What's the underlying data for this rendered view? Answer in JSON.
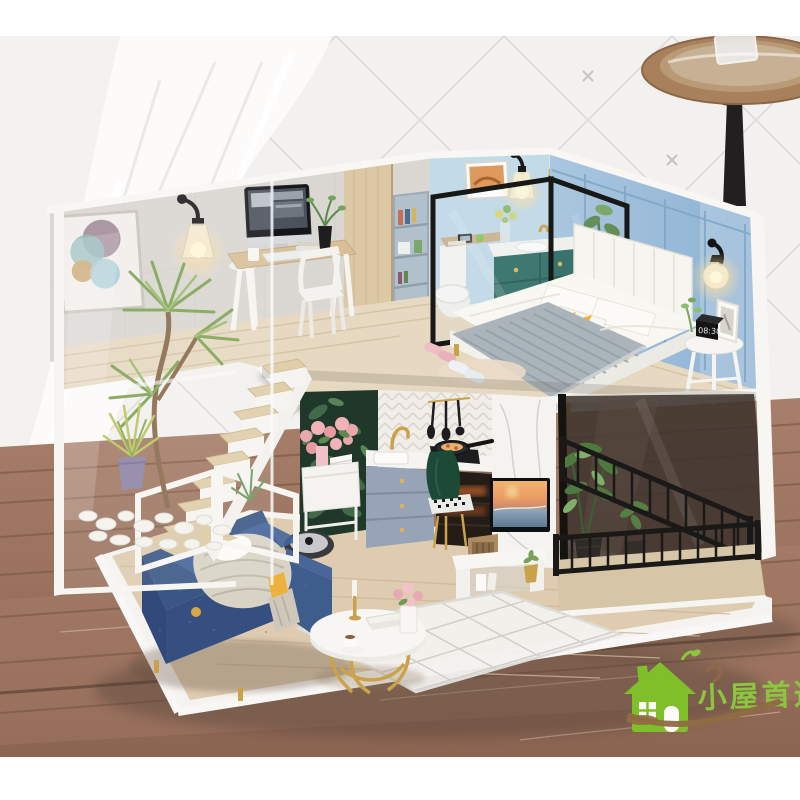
{
  "meta": {
    "domain": "Natural-Image",
    "subject": "Product photo of a DIY miniature dollhouse loft apartment displayed on a rustic wooden table"
  },
  "watermark": {
    "text": "小屋首选",
    "text_color": "#8cc63e",
    "swoosh_color": "#8f6b42",
    "icon": "green-house-icon"
  },
  "scene": {
    "clock_display": "08:30",
    "palette": {
      "background_wall": "#f3f1ef",
      "lace_curtain": "#fcfbfa",
      "table_wood": "#9b7360",
      "house_trim_white": "#f7f6f3",
      "bedroom_wall_blue": "#9cbddb",
      "bathroom_wall_blue": "#c3dae8",
      "vanity_teal": "#2f6b66",
      "sofa_blue": "#3c5c8c",
      "loft_floor_wood": "#e7d9c1",
      "kitchen_cabinet_gray": "#97a3b6",
      "kitchen_leaf_wallpaper": "#20382a",
      "accent_gold": "#c9a24b",
      "plant_green": "#6f9a55",
      "railing_black": "#1b1918",
      "yellow_accent": "#f0b52f"
    },
    "objects": [
      "lace-curtain",
      "quilted-wall",
      "wooden-stool",
      "miniature-loft-dollhouse",
      "desk-with-imac",
      "wall-art-abstract",
      "wall-sconce-lamps",
      "bookshelf",
      "bathroom-toilet",
      "bathroom-vanity",
      "arched-mirror",
      "glass-partition",
      "double-bed",
      "knit-blanket",
      "triangle-pattern-pillow",
      "bedside-table",
      "alarm-clock",
      "slippers",
      "staircase",
      "indoor-plants",
      "white-pebbles",
      "kitchen-counter",
      "gold-faucet",
      "cooktop-with-pan",
      "hanging-utensils",
      "green-velvet-chair",
      "flower-cart",
      "wall-tv-beach-scene",
      "tv-stand",
      "balcony-black-railing",
      "blue-sofa",
      "round-coffee-table",
      "robot-vacuum",
      "diamond-pattern-rug",
      "brand-watermark"
    ]
  }
}
